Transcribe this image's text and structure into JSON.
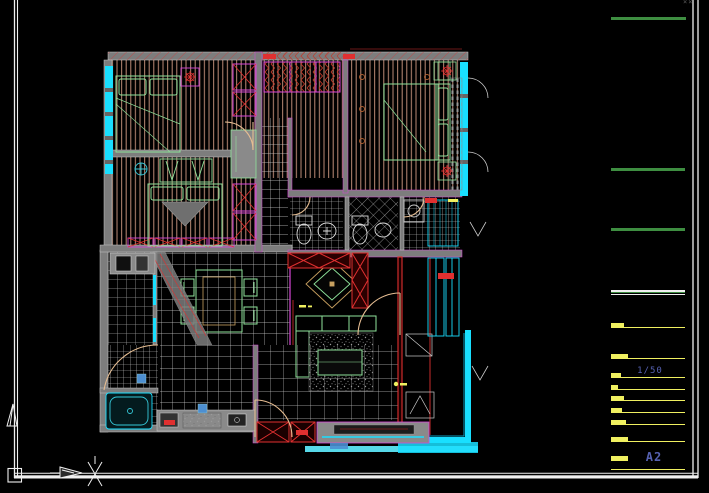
{
  "sheet": {
    "scale_label": "1/50",
    "sheet_code": "A2",
    "corner_mark": "××"
  },
  "colors": {
    "canvas_bg": "#000000",
    "frame_white": "#f0f0f0",
    "green_line": "#3e8e41",
    "yellow": "#f0f060",
    "label_blue": "#5560b0",
    "wall_gray": "#7d7d7d",
    "wall_light": "#c8c8c8",
    "magenta": "#d946d9",
    "hatch_brown": "#bd8b76",
    "window_cyan": "#19dfff",
    "cyan_soft": "#57d8e8",
    "furn_green": "#8fe39b",
    "door_tan": "#e6bd92",
    "accent_red": "#e03030",
    "dark_red": "#8f1f1f",
    "tile_line": "#cfcfcf",
    "tile_dim": "#9a9a9a",
    "blue_accent": "#4d8fd1",
    "gray_mark": "#5a5a5a"
  },
  "titleblock": {
    "left": 611,
    "green_lines": [
      {
        "y": 17,
        "w": 75
      },
      {
        "y": 168,
        "w": 74
      },
      {
        "y": 228,
        "w": 74
      }
    ],
    "divider": {
      "y": 292,
      "w": 74
    },
    "yellow_rows": [
      {
        "y": 327,
        "blob": 13,
        "end": 685
      },
      {
        "y": 358,
        "blob": 17,
        "end": 685
      },
      {
        "y": 377,
        "blob": 10,
        "end": 685
      },
      {
        "y": 389,
        "blob": 7,
        "end": 685
      },
      {
        "y": 400,
        "blob": 13,
        "end": 685
      },
      {
        "y": 412,
        "blob": 11,
        "end": 685
      },
      {
        "y": 424,
        "blob": 15,
        "end": 685
      },
      {
        "y": 441,
        "blob": 17,
        "end": 685
      },
      {
        "y": 460,
        "blob": 17,
        "end": 628
      },
      {
        "y": 469,
        "blob": 0,
        "end": 685
      }
    ]
  },
  "icons": {
    "north_arrow": "open-triangle-up",
    "section_arrow": "open-triangle-right",
    "axis_cross": "x-marker",
    "corner_registration": "quad-box"
  }
}
